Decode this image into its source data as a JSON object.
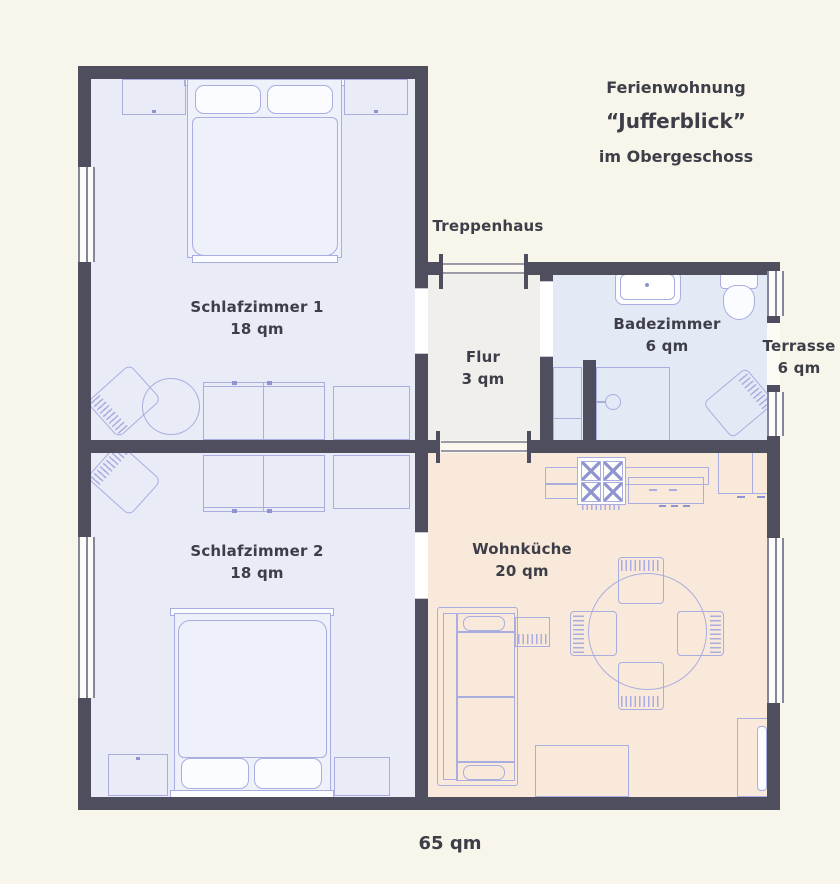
{
  "title_block": {
    "line1": "Ferienwohnung",
    "line2": "“Jufferblick”",
    "line3": "im Obergeschoss"
  },
  "rooms": {
    "schlafzimmer1": {
      "name": "Schlafzimmer 1",
      "area": "18 qm"
    },
    "schlafzimmer2": {
      "name": "Schlafzimmer 2",
      "area": "18 qm"
    },
    "flur": {
      "name": "Flur",
      "area": "3 qm"
    },
    "badezimmer": {
      "name": "Badezimmer",
      "area": "6 qm"
    },
    "wohnkueche": {
      "name": "Wohnküche",
      "area": "20 qm"
    },
    "terrasse": {
      "name": "Terrasse",
      "area": "6 qm"
    },
    "treppenhaus": {
      "name": "Treppenhaus"
    }
  },
  "total_area": "65 qm",
  "colors": {
    "bg": "#f8f5ea",
    "wall": "#4e4e5f",
    "winline": "#86869a",
    "text": "#3e3e49",
    "line": "#a9ade0",
    "line2": "#8f93cf",
    "room-bed": "#e9ebf7",
    "room-bath": "#e4e9f6",
    "room-hall": "#f0efec",
    "room-kitchen": "#f9e9da"
  },
  "furniture": {
    "schlafzimmer1": [
      "double-bed",
      "nightstand-left",
      "nightstand-right",
      "armchair",
      "round-table",
      "wardrobe",
      "dresser"
    ],
    "schlafzimmer2": [
      "double-bed",
      "nightstand-left",
      "nightstand-right",
      "armchair",
      "wardrobe",
      "dresser"
    ],
    "badezimmer": [
      "sink",
      "toilet",
      "shower",
      "cabinet",
      "chair"
    ],
    "wohnkueche": [
      "kitchen-counter",
      "stove",
      "sink-counter",
      "corner-cabinet",
      "dining-table",
      "dining-chair",
      "dining-chair",
      "dining-chair",
      "dining-chair",
      "sofa",
      "side-table",
      "rug",
      "tv-board"
    ]
  }
}
